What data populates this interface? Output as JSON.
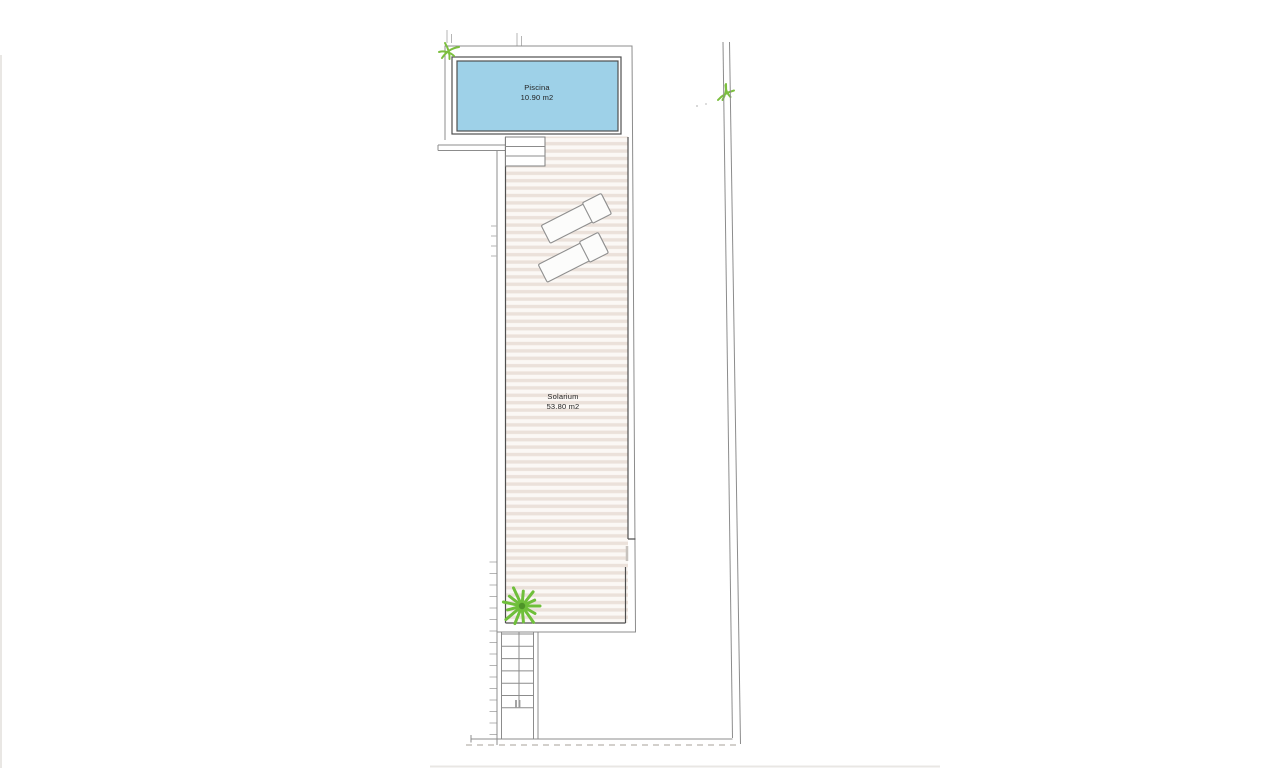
{
  "labels": {
    "pool_name": "Piscina",
    "pool_area": "10.90 m2",
    "solarium_name": "Solarium",
    "solarium_area": "53.80 m2"
  },
  "colors": {
    "pool-water": "#9ed1e8",
    "dark-line": "#4f4f4f",
    "line": "#8c8c8c",
    "deck-stripe": "#ebe1da",
    "deck-base": "#fbf8f5",
    "palm-green": "#6fbf3a",
    "sprig-green": "#7cbf3f",
    "lounger-fill": "#fcfcfb",
    "lounger-stroke": "#8f8f8f",
    "dashed-line": "#b9b4ae",
    "text": "#222222"
  }
}
